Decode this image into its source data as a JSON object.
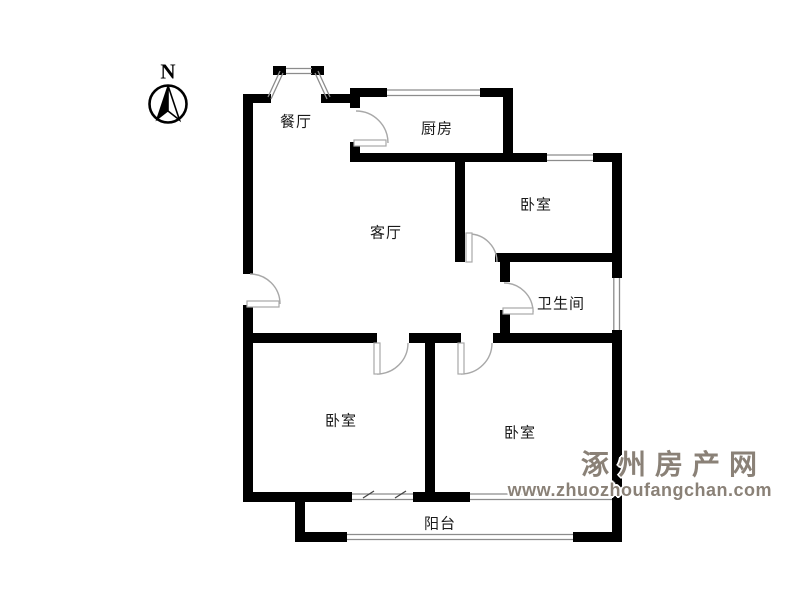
{
  "compass": {
    "label": "N"
  },
  "rooms": {
    "dining": "餐厅",
    "kitchen": "厨房",
    "bedroom_top_right": "卧室",
    "living": "客厅",
    "bathroom": "卫生间",
    "bedroom_bottom_left": "卧室",
    "bedroom_bottom_right": "卧室",
    "balcony": "阳台"
  },
  "watermark": {
    "site_name": "涿州房产网",
    "site_url": "www.zhuozhoufangchan.com"
  },
  "colors": {
    "wall": "#000000",
    "window_line": "#8c8c8c",
    "door_line": "#a8a8a8",
    "watermark_text": "#8a8177",
    "background": "#ffffff"
  }
}
